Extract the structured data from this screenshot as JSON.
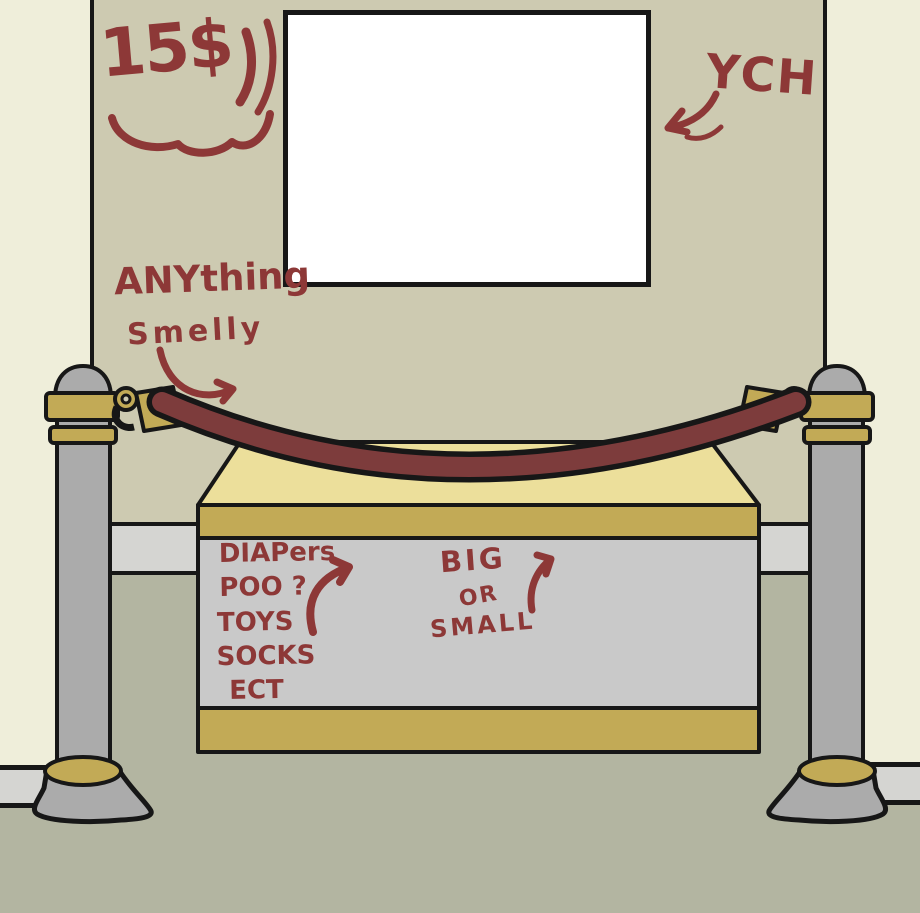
{
  "graffiti": {
    "ink_color": "#8d3837",
    "price_tag": "15$",
    "ych_label": "YCH",
    "wall_note": [
      "ANYthing",
      "Smelly"
    ],
    "pedestal_note": [
      "DIAPers",
      "POO ?",
      "TOYS",
      "SOCKS",
      "ECT"
    ],
    "size_note": [
      "BIG",
      "OR",
      "SMALL"
    ]
  },
  "colors": {
    "ink": "#8d3837",
    "outer_wall": "#efeeda",
    "back_wall": "#cdcab1",
    "baseboard": "#d5d5d2",
    "floor": "#b3b5a1",
    "canvas": "#ffffff",
    "outline": "#171717",
    "pedestal_top": "#ecdf9b",
    "gold_trim": "#c2aa56",
    "pedestal_face": "#c9c9c9",
    "post_gray": "#ababab",
    "rope": "#7d3c3c"
  }
}
